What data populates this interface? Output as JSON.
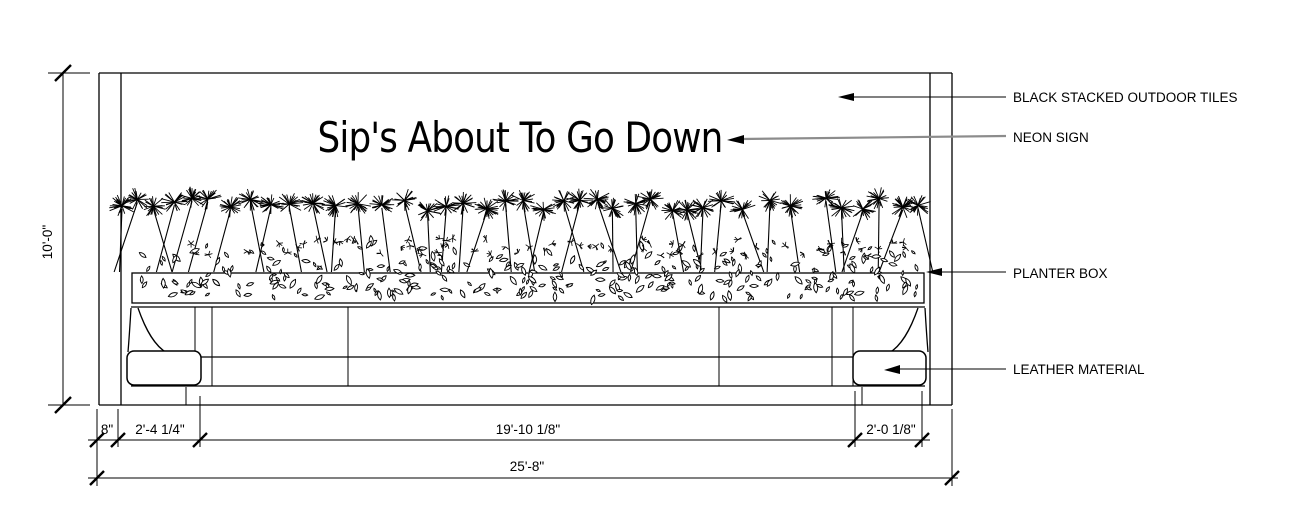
{
  "neon_sign": {
    "text": "Sip's About To Go Down"
  },
  "callouts": {
    "tiles": "BLACK STACKED OUTDOOR TILES",
    "neon": "NEON SIGN",
    "planter": "PLANTER BOX",
    "leather": "LEATHER MATERIAL"
  },
  "dimensions": {
    "height": "10'-0\"",
    "wall_thickness": "8\"",
    "left_segment": "2'-4 1/4\"",
    "center_segment": "19'-10 1/8\"",
    "right_segment": "2'-0 1/8\"",
    "overall_width": "25'-8\""
  },
  "colors": {
    "ink": "#000000",
    "neon_leader": "#8c8c8c",
    "background": "#ffffff"
  }
}
